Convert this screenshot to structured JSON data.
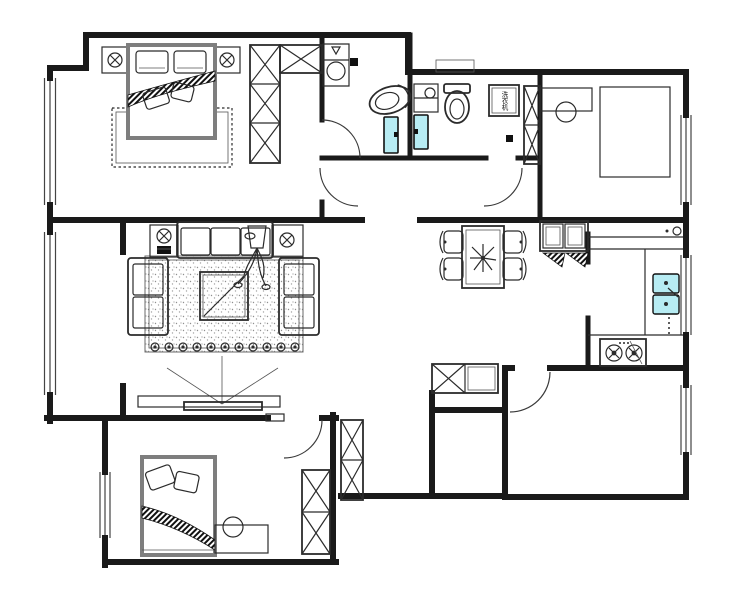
{
  "canvas": {
    "width": 740,
    "height": 600,
    "background": "#ffffff"
  },
  "colors": {
    "wall_line": "#1a1a1a",
    "furniture_line": "#2b2b2b",
    "glass_fill": "#b7ecf3",
    "glass_stroke": "#101010",
    "hatch_fill": "#111111",
    "rug_dot": "#8f8f8f"
  },
  "labels": {
    "washing_machine": "洗衣机"
  },
  "fixtures": [
    "double-bed",
    "single-bed",
    "nightstand-lamp",
    "wardrobe-x-cabinet",
    "toilet",
    "corner-washbasin",
    "washing-machine",
    "shower-glass-panel",
    "sofa-three-seat",
    "loveseat",
    "coffee-table",
    "area-rug",
    "tv-on-cabinet",
    "floor-plant",
    "dining-table",
    "dining-chair",
    "sideboard",
    "double-sink",
    "gas-stove",
    "desk",
    "stool",
    "shoe-cabinet",
    "door-swing",
    "window"
  ]
}
